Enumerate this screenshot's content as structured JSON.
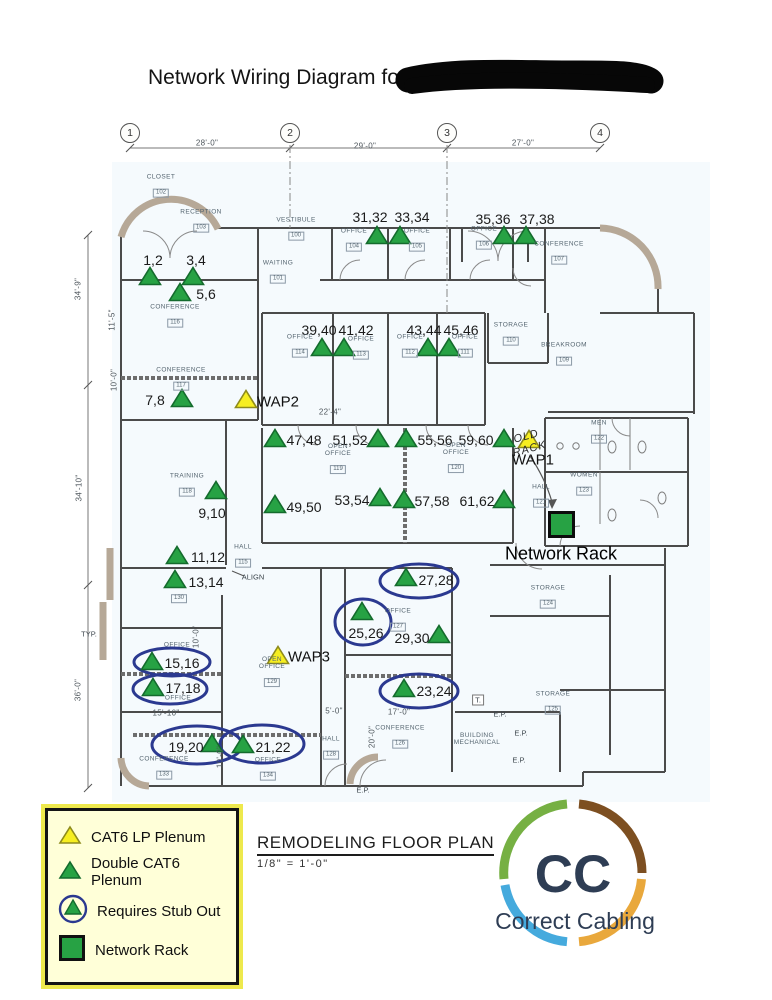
{
  "title": "Network Wiring Diagram for",
  "redacted_after_title": true,
  "grid": {
    "columns": [
      {
        "label": "1",
        "x": 130
      },
      {
        "label": "2",
        "x": 290
      },
      {
        "label": "3",
        "x": 447
      },
      {
        "label": "4",
        "x": 600
      }
    ],
    "bubble_y": 133,
    "top_dimensions": [
      {
        "text": "28'-0\"",
        "x": 207,
        "y": 143
      },
      {
        "text": "29'-0\"",
        "x": 365,
        "y": 146
      },
      {
        "text": "27'-0\"",
        "x": 523,
        "y": 143
      }
    ]
  },
  "dimensions": [
    {
      "text": "34'-9\"",
      "x": 78,
      "y": 289,
      "vertical": true
    },
    {
      "text": "34'-10\"",
      "x": 79,
      "y": 488,
      "vertical": true
    },
    {
      "text": "36'-0\"",
      "x": 78,
      "y": 690,
      "vertical": true
    },
    {
      "text": "11'-5\"",
      "x": 112,
      "y": 320,
      "vertical": true
    },
    {
      "text": "10'-0\"",
      "x": 114,
      "y": 380,
      "vertical": true
    },
    {
      "text": "22'-4\"",
      "x": 330,
      "y": 412
    },
    {
      "text": "10'-0\"",
      "x": 196,
      "y": 637,
      "vertical": true
    },
    {
      "text": "15'-10\"",
      "x": 166,
      "y": 713
    },
    {
      "text": "10'-0\"",
      "x": 220,
      "y": 757,
      "vertical": true
    },
    {
      "text": "5'-0\"",
      "x": 334,
      "y": 711
    },
    {
      "text": "17'-0\"",
      "x": 399,
      "y": 712
    },
    {
      "text": "20'-0\"",
      "x": 372,
      "y": 737,
      "vertical": true
    }
  ],
  "rooms": [
    {
      "lines": [
        "CLOSET"
      ],
      "tag": "102",
      "x": 161,
      "y": 186
    },
    {
      "lines": [
        "RECEPTION"
      ],
      "tag": "103",
      "x": 201,
      "y": 221
    },
    {
      "lines": [
        "VESTIBULE"
      ],
      "tag": "100",
      "x": 296,
      "y": 229
    },
    {
      "lines": [
        "WAITING"
      ],
      "tag": "101",
      "x": 278,
      "y": 272
    },
    {
      "lines": [
        "OFFICE"
      ],
      "tag": "104",
      "x": 354,
      "y": 240
    },
    {
      "lines": [
        "OFFICE"
      ],
      "tag": "105",
      "x": 417,
      "y": 240
    },
    {
      "lines": [
        "OFFICE"
      ],
      "tag": "106",
      "x": 484,
      "y": 238
    },
    {
      "lines": [
        "CONFERENCE"
      ],
      "tag": "107",
      "x": 559,
      "y": 253
    },
    {
      "lines": [
        "CONFERENCE"
      ],
      "tag": "116",
      "x": 175,
      "y": 316
    },
    {
      "lines": [
        "CONFERENCE"
      ],
      "tag": "117",
      "x": 181,
      "y": 379
    },
    {
      "lines": [
        "OFFICE"
      ],
      "tag": "114",
      "x": 300,
      "y": 346
    },
    {
      "lines": [
        "OFFICE"
      ],
      "tag": "113",
      "x": 361,
      "y": 348
    },
    {
      "lines": [
        "OFFICE"
      ],
      "tag": "112",
      "x": 410,
      "y": 346
    },
    {
      "lines": [
        "OFFICE"
      ],
      "tag": "111",
      "x": 465,
      "y": 346
    },
    {
      "lines": [
        "STORAGE"
      ],
      "tag": "110",
      "x": 511,
      "y": 334
    },
    {
      "lines": [
        "BREAKROOM"
      ],
      "tag": "109",
      "x": 564,
      "y": 354
    },
    {
      "lines": [
        "TRAINING"
      ],
      "tag": "118",
      "x": 187,
      "y": 485
    },
    {
      "lines": [
        "OPEN",
        "OFFICE"
      ],
      "tag": "119",
      "x": 338,
      "y": 459
    },
    {
      "lines": [
        "OPEN",
        "OFFICE"
      ],
      "tag": "120",
      "x": 456,
      "y": 458
    },
    {
      "lines": [
        "HALL"
      ],
      "tag": "115",
      "x": 243,
      "y": 556
    },
    {
      "lines": [
        "MEN"
      ],
      "tag": "122",
      "x": 599,
      "y": 432
    },
    {
      "lines": [
        "WOMEN"
      ],
      "tag": "123",
      "x": 584,
      "y": 484
    },
    {
      "lines": [
        "HALL"
      ],
      "tag": "121",
      "x": 541,
      "y": 496
    },
    {
      "lines": [
        ""
      ],
      "tag": "130",
      "x": 179,
      "y": 595
    },
    {
      "lines": [
        "STORAGE"
      ],
      "tag": "124",
      "x": 548,
      "y": 597
    },
    {
      "lines": [
        "OFFICE"
      ],
      "tag": "127",
      "x": 398,
      "y": 620
    },
    {
      "lines": [
        "OPEN",
        "OFFICE"
      ],
      "tag": "129",
      "x": 272,
      "y": 672
    },
    {
      "lines": [
        "OFFICE"
      ],
      "tag": null,
      "x": 177,
      "y": 645
    },
    {
      "lines": [
        "OFFICE"
      ],
      "tag": null,
      "x": 178,
      "y": 698
    },
    {
      "lines": [
        "CONFERENCE"
      ],
      "tag": "133",
      "x": 164,
      "y": 768
    },
    {
      "lines": [
        "OFFICE"
      ],
      "tag": "134",
      "x": 268,
      "y": 769
    },
    {
      "lines": [
        "HALL"
      ],
      "tag": "128",
      "x": 331,
      "y": 748
    },
    {
      "lines": [
        "CONFERENCE"
      ],
      "tag": "126",
      "x": 400,
      "y": 737
    },
    {
      "lines": [
        "BUILDING",
        "MECHANICAL"
      ],
      "tag": null,
      "x": 477,
      "y": 739
    },
    {
      "lines": [
        "STORAGE"
      ],
      "tag": "125",
      "x": 553,
      "y": 703
    }
  ],
  "markers": [
    {
      "label": "1,2",
      "tx": 150,
      "ty": 277,
      "lx": 153,
      "ly": 260
    },
    {
      "label": "3,4",
      "tx": 193,
      "ty": 277,
      "lx": 196,
      "ly": 260
    },
    {
      "label": "5,6",
      "tx": 180,
      "ty": 293,
      "lx": 206,
      "ly": 294
    },
    {
      "label": "7,8",
      "tx": 182,
      "ty": 399,
      "lx": 155,
      "ly": 400
    },
    {
      "label": "9,10",
      "tx": 216,
      "ty": 491,
      "lx": 212,
      "ly": 513
    },
    {
      "label": "11,12",
      "tx": 177,
      "ty": 556,
      "lx": 208,
      "ly": 557
    },
    {
      "label": "13,14",
      "tx": 175,
      "ty": 580,
      "lx": 206,
      "ly": 582
    },
    {
      "label": "15,16",
      "tx": 152,
      "ty": 662,
      "lx": 182,
      "ly": 663,
      "circled": true
    },
    {
      "label": "17,18",
      "tx": 153,
      "ty": 688,
      "lx": 183,
      "ly": 688,
      "circled": true
    },
    {
      "label": "19,20",
      "tx": 212,
      "ty": 744,
      "lx": 186,
      "ly": 747,
      "circled": true
    },
    {
      "label": "21,22",
      "tx": 243,
      "ty": 745,
      "lx": 273,
      "ly": 747,
      "circled": true
    },
    {
      "label": "23,24",
      "tx": 404,
      "ty": 689,
      "lx": 434,
      "ly": 691,
      "circled": true
    },
    {
      "label": "25,26",
      "tx": 362,
      "ty": 612,
      "lx": 366,
      "ly": 633,
      "circled": true
    },
    {
      "label": "27,28",
      "tx": 406,
      "ty": 578,
      "lx": 436,
      "ly": 580,
      "circled": true
    },
    {
      "label": "29,30",
      "tx": 439,
      "ty": 635,
      "lx": 412,
      "ly": 638
    },
    {
      "label": "31,32",
      "tx": 377,
      "ty": 236,
      "lx": 370,
      "ly": 217
    },
    {
      "label": "33,34",
      "tx": 400,
      "ty": 236,
      "lx": 412,
      "ly": 217
    },
    {
      "label": "35,36",
      "tx": 504,
      "ty": 236,
      "lx": 493,
      "ly": 219
    },
    {
      "label": "37,38",
      "tx": 526,
      "ty": 236,
      "lx": 537,
      "ly": 219
    },
    {
      "label": "39,40",
      "tx": 322,
      "ty": 348,
      "lx": 319,
      "ly": 330
    },
    {
      "label": "41,42",
      "tx": 344,
      "ty": 348,
      "lx": 356,
      "ly": 330
    },
    {
      "label": "43,44",
      "tx": 428,
      "ty": 348,
      "lx": 424,
      "ly": 330
    },
    {
      "label": "45,46",
      "tx": 449,
      "ty": 348,
      "lx": 461,
      "ly": 330
    },
    {
      "label": "47,48",
      "tx": 275,
      "ty": 439,
      "lx": 304,
      "ly": 440
    },
    {
      "label": "49,50",
      "tx": 275,
      "ty": 505,
      "lx": 304,
      "ly": 507
    },
    {
      "label": "51,52",
      "tx": 378,
      "ty": 439,
      "lx": 350,
      "ly": 440
    },
    {
      "label": "53,54",
      "tx": 380,
      "ty": 498,
      "lx": 352,
      "ly": 500
    },
    {
      "label": "55,56",
      "tx": 406,
      "ty": 439,
      "lx": 435,
      "ly": 440
    },
    {
      "label": "57,58",
      "tx": 404,
      "ty": 500,
      "lx": 432,
      "ly": 501
    },
    {
      "label": "59,60",
      "tx": 504,
      "ty": 439,
      "lx": 476,
      "ly": 440
    },
    {
      "label": "61,62",
      "tx": 504,
      "ty": 500,
      "lx": 477,
      "ly": 501
    }
  ],
  "wap_markers": [
    {
      "label": "WAP2",
      "tx": 246,
      "ty": 400,
      "lx": 278,
      "ly": 402
    },
    {
      "label": "WAP1",
      "tx": 529,
      "ty": 440,
      "lx": 533,
      "ly": 460
    },
    {
      "label": "WAP3",
      "tx": 278,
      "ty": 656,
      "lx": 309,
      "ly": 657
    }
  ],
  "stub_ellipses": [
    {
      "cx": 172,
      "cy": 662,
      "rx": 38,
      "ry": 14
    },
    {
      "cx": 170,
      "cy": 689,
      "rx": 37,
      "ry": 15
    },
    {
      "cx": 197,
      "cy": 745,
      "rx": 45,
      "ry": 19
    },
    {
      "cx": 262,
      "cy": 744,
      "rx": 42,
      "ry": 19
    },
    {
      "cx": 419,
      "cy": 691,
      "rx": 39,
      "ry": 17
    },
    {
      "cx": 363,
      "cy": 622,
      "rx": 28,
      "ry": 23
    },
    {
      "cx": 419,
      "cy": 581,
      "rx": 39,
      "ry": 17
    }
  ],
  "network_rack": {
    "x": 548,
    "y": 511,
    "size": 27,
    "label": "Network Rack",
    "label_x": 561,
    "label_y": 554
  },
  "annotations": [
    {
      "text": "ALIGN",
      "x": 253,
      "y": 577
    },
    {
      "text": "E.P.",
      "x": 500,
      "y": 714
    },
    {
      "text": "E.P.",
      "x": 521,
      "y": 733
    },
    {
      "text": "E.P.",
      "x": 519,
      "y": 760
    },
    {
      "text": "E.P.",
      "x": 363,
      "y": 790
    },
    {
      "text": "TYP.",
      "x": 89,
      "y": 634
    },
    {
      "text": "T.",
      "x": 478,
      "y": 700
    }
  ],
  "old_rack_note": {
    "lines": [
      "OLD",
      "RACK"
    ],
    "x": 528,
    "y": 443
  },
  "legend": {
    "items": [
      {
        "icon": "cat6-lp-triangle",
        "label": "CAT6 LP Plenum"
      },
      {
        "icon": "double-cat6-triangle",
        "label": "Double CAT6 Plenum"
      },
      {
        "icon": "stub-out-circle",
        "label": "Requires Stub Out"
      },
      {
        "icon": "network-rack-square",
        "label": "Network Rack"
      }
    ]
  },
  "plan_title": {
    "text": "REMODELING FLOOR PLAN",
    "scale": "1/8\" = 1'-0\""
  },
  "logo": {
    "initials": "CC",
    "name": "Correct Cabling"
  },
  "colors": {
    "cat6_green": "#27a244",
    "cat6_green_edge": "#146b2d",
    "wap_yellow": "#f6ee21",
    "wap_yellow_edge": "#8e8b1c",
    "stub_blue": "#2b3990",
    "legend_bg": "#ffffd8",
    "logo_green": "#76b043",
    "logo_brown": "#7d4f21",
    "logo_blue": "#45aadd",
    "logo_gold": "#e9a83c",
    "logo_text": "#2e3d54"
  }
}
